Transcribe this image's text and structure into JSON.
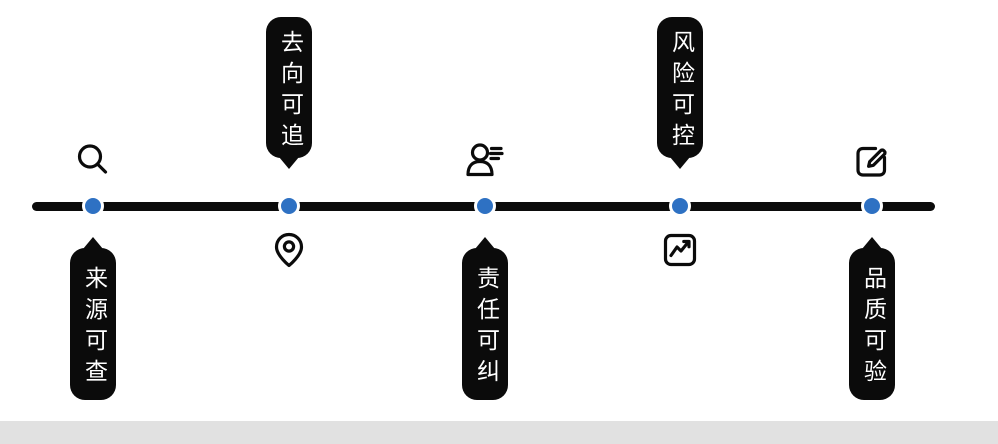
{
  "diagram": {
    "type": "horizontal-timeline",
    "background_color": "#ffffff",
    "line_color": "#0b0b0b",
    "dot_color": "#2e71c3",
    "callout_bg_color": "#0b0b0b",
    "callout_text_color": "#ffffff",
    "footer_bar_color": "#e1e1e1"
  },
  "nodes": [
    {
      "label": "来源可查",
      "icon": "search-icon",
      "icon_position": "above",
      "label_position": "below"
    },
    {
      "label": "去向可追",
      "icon": "map-pin-icon",
      "icon_position": "below",
      "label_position": "above"
    },
    {
      "label": "责任可纠",
      "icon": "person-list-icon",
      "icon_position": "above",
      "label_position": "below"
    },
    {
      "label": "风险可控",
      "icon": "chart-trend-icon",
      "icon_position": "below",
      "label_position": "above"
    },
    {
      "label": "品质可验",
      "icon": "edit-icon",
      "icon_position": "above",
      "label_position": "below"
    }
  ]
}
